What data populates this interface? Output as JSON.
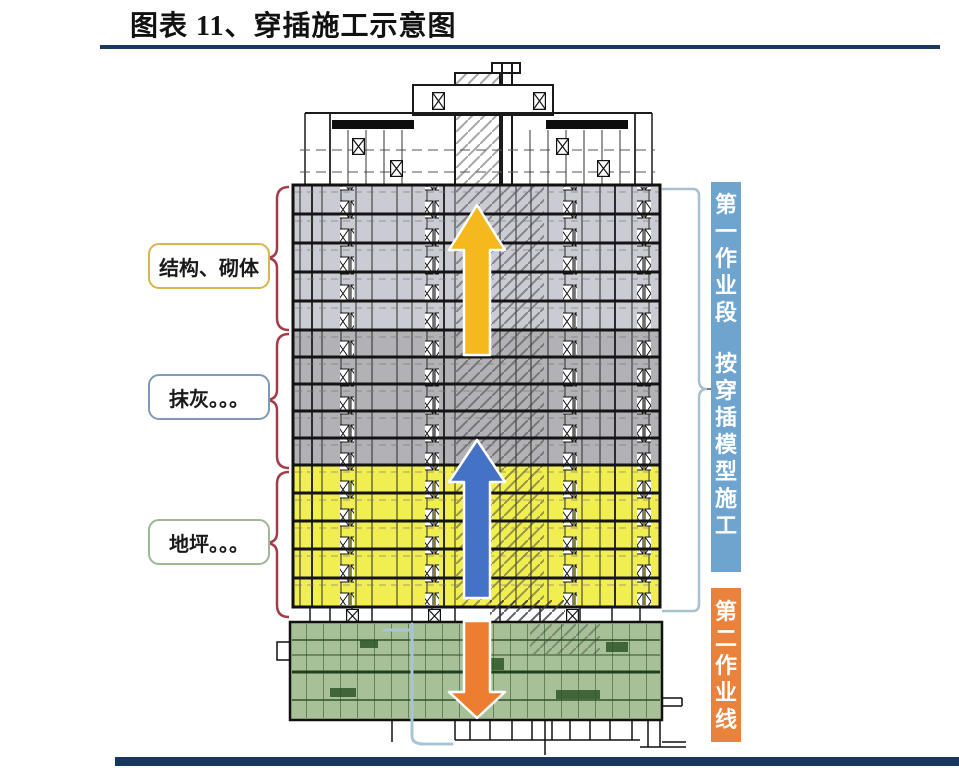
{
  "figure": {
    "title": "图表 11、穿插施工示意图"
  },
  "left_labels": [
    {
      "text": "结构、砌体",
      "border_color": "#d9b54a"
    },
    {
      "text": "抹灰。。。",
      "border_color": "#7f9ab6"
    },
    {
      "text": "地坪。。。",
      "border_color": "#9fb795"
    }
  ],
  "right_annotations": {
    "section1": {
      "title": "第一作业段",
      "subtitle": "按穿插模型施工",
      "bar_color": "#6fa4cf"
    },
    "section2": {
      "title": "第二作业线",
      "bar_color": "#e8823c"
    }
  },
  "colors": {
    "rule_navy": "#17375e",
    "floors_upper_gray": "#cbccd3",
    "floors_mid_gray": "#b2b2b6",
    "floors_yellow": "#f1ee52",
    "podium_green": "#a8c097",
    "arrow_gold": "#f5b91e",
    "arrow_blue": "#4472c4",
    "arrow_orange": "#ed7d31",
    "brace_red": "#a33c46",
    "bracket_light_blue": "#a6c2cd"
  }
}
